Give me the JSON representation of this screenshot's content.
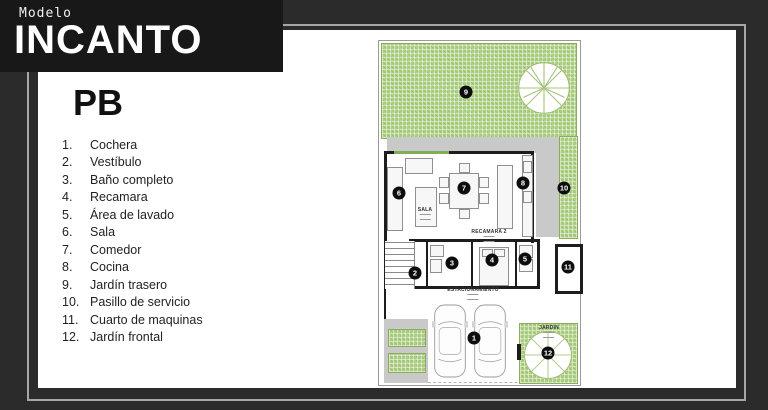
{
  "banner": {
    "eyebrow": "Modelo",
    "title": "INCANTO"
  },
  "legend": {
    "title": "PB",
    "items": [
      {
        "num": "1.",
        "label": "Cochera"
      },
      {
        "num": "2.",
        "label": "Vestíbulo"
      },
      {
        "num": "3.",
        "label": "Baño completo"
      },
      {
        "num": "4.",
        "label": "Recamara"
      },
      {
        "num": "5.",
        "label": "Área de lavado"
      },
      {
        "num": "6.",
        "label": "Sala"
      },
      {
        "num": "7.",
        "label": "Comedor"
      },
      {
        "num": "8.",
        "label": "Cocina"
      },
      {
        "num": "9.",
        "label": "Jardín trasero"
      },
      {
        "num": "10.",
        "label": "Pasillo de servicio"
      },
      {
        "num": "11.",
        "label": "Cuarto de maquinas"
      },
      {
        "num": "12.",
        "label": "Jardín frontal"
      }
    ]
  },
  "plan": {
    "room_labels": [
      {
        "id": "sala",
        "text": "SALA",
        "x": 46,
        "y": 166
      },
      {
        "id": "recamara-2",
        "text": "RECAMARA 2",
        "x": 110,
        "y": 188
      },
      {
        "id": "estacionamiento",
        "text": "ESTACIONAMIENTO",
        "x": 94,
        "y": 246
      },
      {
        "id": "jardin",
        "text": "JARDIN",
        "x": 170,
        "y": 284
      }
    ],
    "markers": [
      {
        "n": "1",
        "x": 95,
        "y": 297
      },
      {
        "n": "2",
        "x": 36,
        "y": 232
      },
      {
        "n": "3",
        "x": 73,
        "y": 222
      },
      {
        "n": "4",
        "x": 113,
        "y": 219
      },
      {
        "n": "5",
        "x": 146,
        "y": 218
      },
      {
        "n": "6",
        "x": 20,
        "y": 152
      },
      {
        "n": "7",
        "x": 85,
        "y": 147
      },
      {
        "n": "8",
        "x": 144,
        "y": 142
      },
      {
        "n": "9",
        "x": 87,
        "y": 51
      },
      {
        "n": "10",
        "x": 185,
        "y": 147
      },
      {
        "n": "11",
        "x": 189,
        "y": 226
      },
      {
        "n": "12",
        "x": 169,
        "y": 312
      }
    ]
  },
  "colors": {
    "background": "#2b2b2b",
    "banner": "#181818",
    "panel": "#ffffff",
    "garden_green": "#aed084",
    "wall": "#1d1d1d",
    "terrace_gray": "#c9c9c9",
    "frame_line": "#a6a6a6",
    "marker": "#0d0d0d"
  }
}
